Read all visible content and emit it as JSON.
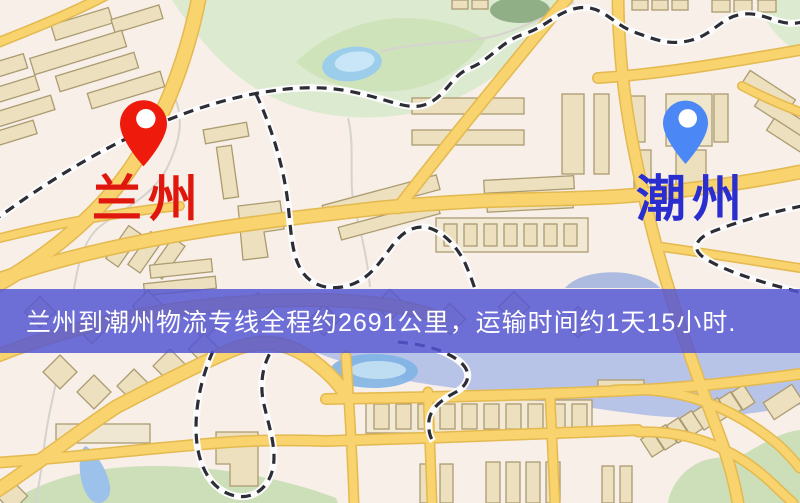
{
  "origin": {
    "label": "兰州",
    "label_color": "#e0170c",
    "pin_color": "#ee1b0d"
  },
  "destination": {
    "label": "潮州",
    "label_color": "#2a2ecf",
    "pin_color": "#4b87f5"
  },
  "banner": {
    "text": "兰州到潮州物流专线全程约2691公里，运输时间约1天15小时.",
    "background": "rgba(83,85,211,0.84)",
    "text_color": "#ffffff"
  },
  "route": {
    "distance_km": "2691",
    "duration": "1天15小时"
  }
}
